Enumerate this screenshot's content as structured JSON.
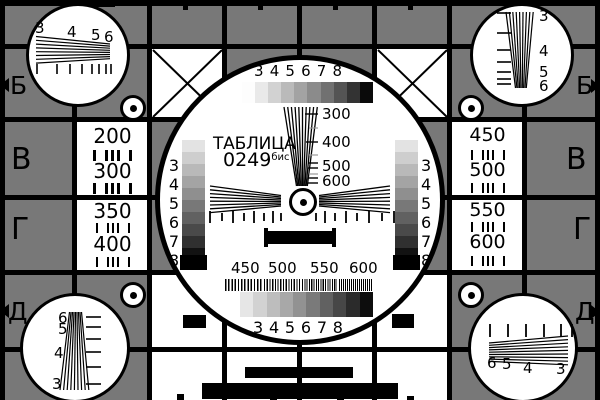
{
  "card": {
    "name": "Телевизионная испытательная таблица 0249 бис",
    "title_line1": "ТАБЛИЦА",
    "title_number": "0249",
    "title_suffix": "бис"
  },
  "colors": {
    "background_gray": "#787878",
    "white": "#ffffff",
    "black": "#000000"
  },
  "grayscale": {
    "top_steps": [
      "#fdfdfd",
      "#e9e9e9",
      "#d2d2d2",
      "#bababa",
      "#a3a3a3",
      "#8b8b8b",
      "#717171",
      "#545454",
      "#333333",
      "#0a0a0a"
    ],
    "bottom_steps": [
      "#e6e6e6",
      "#d2d2d2",
      "#bdbdbd",
      "#a8a8a8",
      "#929292",
      "#7a7a7a",
      "#616161",
      "#474747",
      "#2b2b2b",
      "#0d0d0d"
    ],
    "left_steps": [
      "#e3e3e3",
      "#cecece",
      "#b9b9b9",
      "#a4a4a4",
      "#8f8f8f",
      "#787878",
      "#616161",
      "#4a4a4a",
      "#303030",
      "#121212"
    ],
    "right_steps": [
      "#e3e3e3",
      "#cecece",
      "#b9b9b9",
      "#a4a4a4",
      "#8f8f8f",
      "#787878",
      "#616161",
      "#4a4a4a",
      "#303030",
      "#121212"
    ]
  },
  "scales": {
    "top_labels": [
      "3",
      "4",
      "5",
      "6",
      "7",
      "8"
    ],
    "bottom_labels": [
      "3",
      "4",
      "5",
      "6",
      "7",
      "8"
    ],
    "left_labels": [
      "3",
      "4",
      "5",
      "6",
      "7",
      "8"
    ],
    "right_labels": [
      "3",
      "4",
      "5",
      "6",
      "7",
      "8"
    ],
    "center_wedge_labels": [
      "300",
      "400",
      "500",
      "600"
    ],
    "bottom_freq_labels": [
      "450",
      "500",
      "550",
      "600"
    ]
  },
  "panels": {
    "left_top": [
      "200",
      "300"
    ],
    "left_bottom": [
      "350",
      "400"
    ],
    "right_top": [
      "450",
      "500"
    ],
    "right_bottom": [
      "550",
      "600"
    ]
  },
  "edge_labels": {
    "left_b": "Б",
    "left_v": "В",
    "left_g": "Г",
    "left_d": "Д",
    "right_b": "Б",
    "right_v": "В",
    "right_g": "Г",
    "right_d": "Д"
  },
  "corner_wedge_labels": {
    "top_left": [
      "3",
      "4",
      "5",
      "6"
    ],
    "top_right": [
      "3",
      "4",
      "5",
      "6"
    ],
    "bottom_left": [
      "6",
      "5",
      "4",
      "3"
    ],
    "bottom_right": [
      "6",
      "5",
      "4",
      "3"
    ]
  }
}
